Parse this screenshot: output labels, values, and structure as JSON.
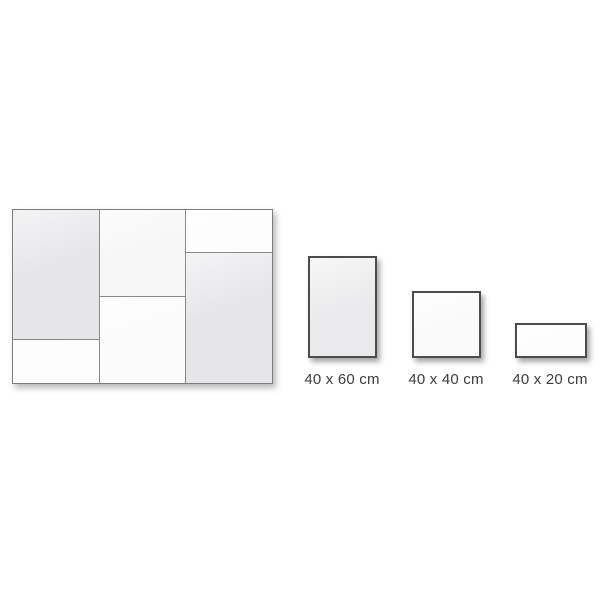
{
  "page": {
    "background_color": "#ffffff",
    "text_color": "#3d3d3d"
  },
  "arrangement": {
    "description": "example wall layout composed of six tiles",
    "outer_border_color": "#7d7d7d",
    "divider_color": "#8a8a8a",
    "shadow_color": "rgba(0,0,0,0.28)",
    "panels": [
      {
        "position": "left-top",
        "size": "40 x 60 cm",
        "fill": "#e6e6e9"
      },
      {
        "position": "left-bottom",
        "size": "40 x 20 cm",
        "fill": "#fcfcfc"
      },
      {
        "position": "middle-top",
        "size": "40 x 40 cm",
        "fill": "#f7f7f8"
      },
      {
        "position": "middle-bottom",
        "size": "40 x 40 cm",
        "fill": "#fbfbfb"
      },
      {
        "position": "right-top",
        "size": "40 x 20 cm",
        "fill": "#fdfdfd"
      },
      {
        "position": "right-bottom",
        "size": "40 x 60 cm",
        "fill": "#e6e6e9"
      }
    ]
  },
  "size_options": [
    {
      "label": "40 x 60 cm",
      "fill": "#eaeaec"
    },
    {
      "label": "40 x 40 cm",
      "fill": "#fafafa"
    },
    {
      "label": "40 x 20 cm",
      "fill": "#fdfdfd"
    }
  ],
  "tile_border_color": "#4c4c4c"
}
